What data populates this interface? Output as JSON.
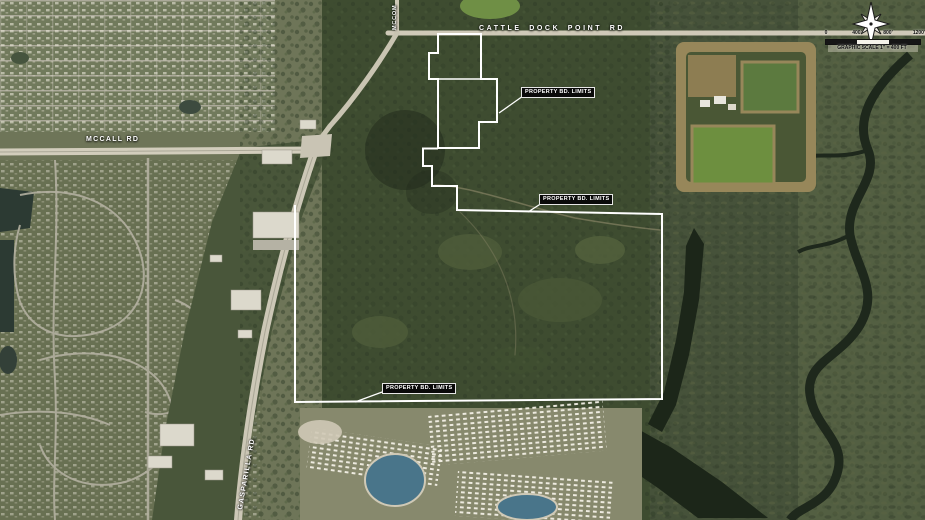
{
  "map": {
    "road_labels": {
      "cattle_dock": "CATTLE DOCK POINT RD",
      "mccall": "MCCALL RD",
      "gasparilla": "GASPARILLA RD",
      "north_road_partial": "MCCOM"
    },
    "property_labels": [
      "PROPERTY BD. LIMITS",
      "PROPERTY BD. LIMITS",
      "PROPERTY BD. LIMITS"
    ],
    "scale": {
      "ticks": [
        "0",
        "400'",
        "800'",
        "1200'"
      ],
      "caption": "GRAPHIC SCALE 1\" = 400 FT"
    },
    "colors": {
      "boundary_line": "#ffffff",
      "label_background": "#0a0a0a",
      "label_text": "#ffffff"
    }
  }
}
